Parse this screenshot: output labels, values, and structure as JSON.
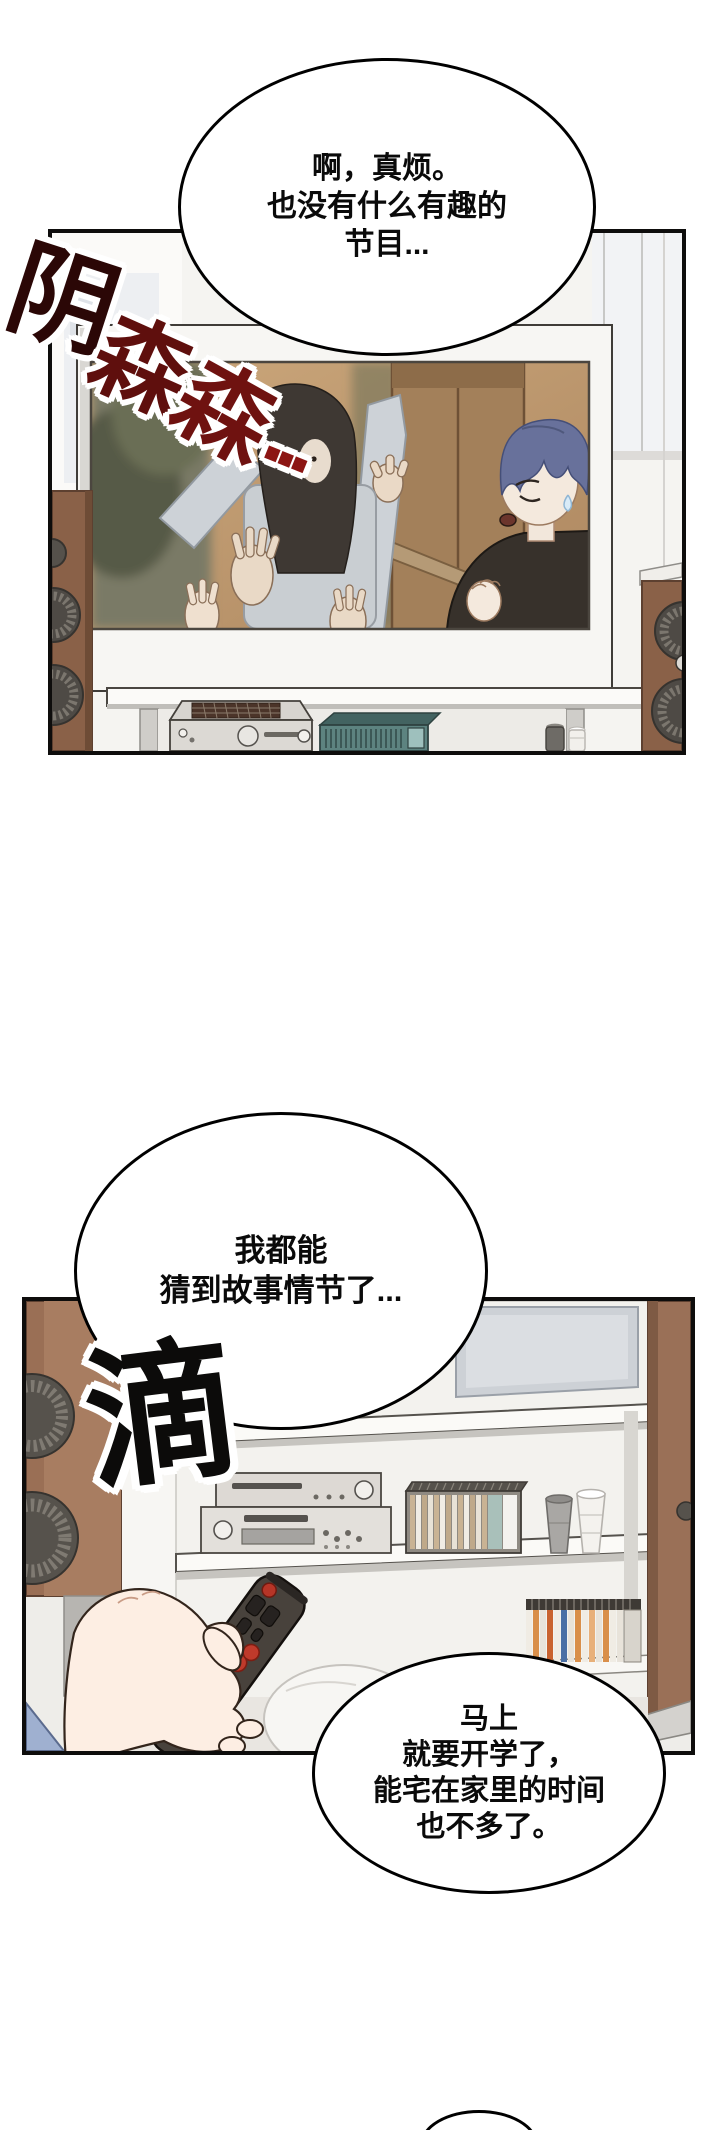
{
  "page": {
    "width": 720,
    "height": 2130,
    "background": "#ffffff",
    "type": "webtoon-comic-page"
  },
  "panels": [
    {
      "id": "panel-1",
      "scene": "tv showing horror show: ghost with raised hands scaring a blue-haired man in black shirt, speakers and audio equipment around tv",
      "border_color": "#0e0d0c"
    },
    {
      "id": "panel-2",
      "scene": "hand pointing tv remote at a white media shelf with stereo, cd rack, cups and speakers",
      "border_color": "#0e0d0c"
    }
  ],
  "bubbles": {
    "bubble1": {
      "lines": [
        "啊，真烦。",
        "也没有什么有趣的",
        "节目..."
      ]
    },
    "bubble2": {
      "lines": [
        "我都能",
        "猜到故事情节了..."
      ]
    },
    "bubble3": {
      "lines": [
        "马上",
        "就要开学了，",
        "能宅在家里的时间",
        "也不多了。"
      ]
    }
  },
  "sfx": {
    "sfx1": {
      "text": "阴森森...",
      "chars": [
        "阴",
        "森",
        "森",
        "..."
      ],
      "colors": [
        "#2b0706",
        "#5f0f0d",
        "#6f1210",
        "#8c1513"
      ],
      "outline": "#ffffff"
    },
    "sfx2": {
      "text": "滴",
      "color": "#0c0b0a",
      "outline": "#ffffff"
    }
  },
  "palette": {
    "wall": "#f5f4f1",
    "speaker_wood": "#8a6148",
    "speaker_wood_panel2": "#a87d61",
    "tv_frame": "#f7f6f3",
    "screen_backdrop_tan": "#c9a478",
    "wardrobe": "#a3805a",
    "ghost_clothes": "#c9ced2",
    "man_hair": "#68719b",
    "man_shirt": "#37312b",
    "skin": "#f4e9dd",
    "remote_body": "#48423c",
    "remote_red_button": "#bf3a2b",
    "remote_beige_button": "#e2d5a3",
    "teal_device": "#5d8380"
  }
}
